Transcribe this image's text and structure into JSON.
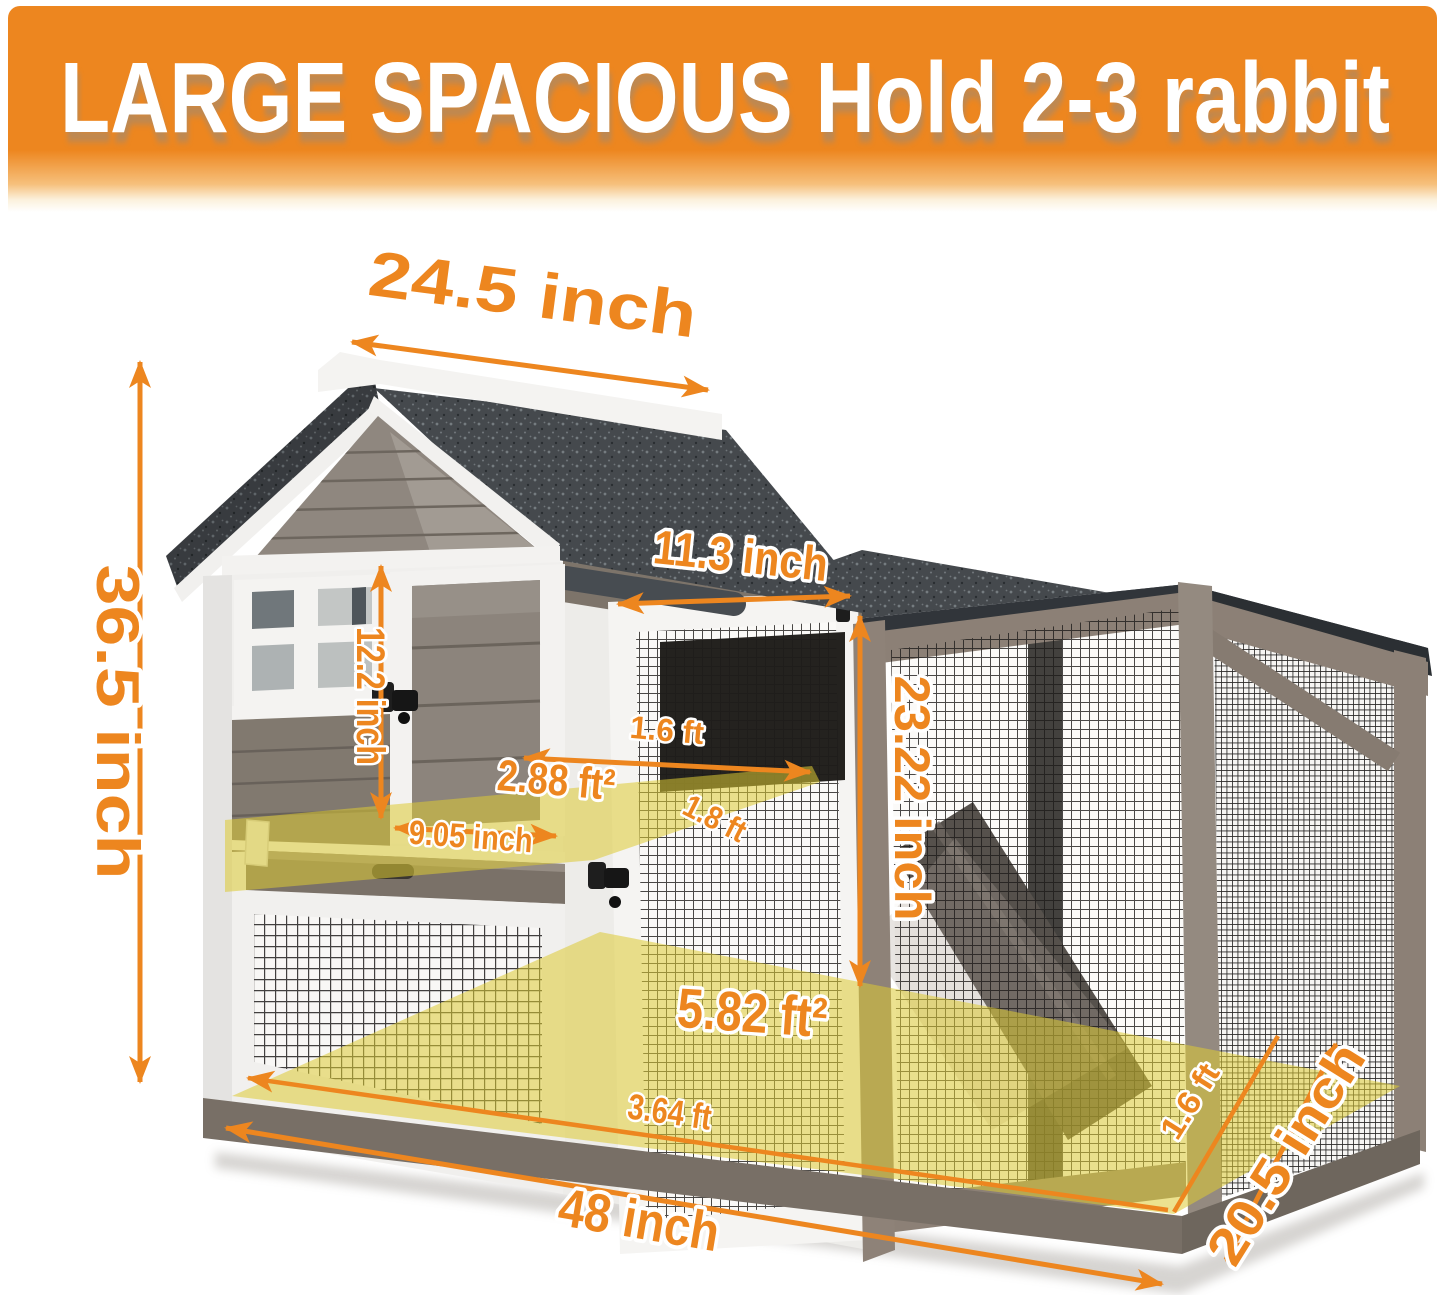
{
  "banner": {
    "title": "LARGE SPACIOUS Hold 2-3 rabbit",
    "bg_color": "#ED861F",
    "text_color": "#FFFFFF"
  },
  "dimensions": {
    "roof_width": "24.5 inch",
    "total_height": "36.5 inch",
    "door_width": "11.3 inch",
    "door_height": "12.2 inch",
    "platform_depth": "1.6 ft",
    "platform_area": "2.88 ft²",
    "platform_width": "9.05 inch",
    "platform_diagonal": "1.8 ft",
    "run_height": "23.22 inch",
    "floor_area": "5.82 ft²",
    "floor_front_width": "3.64 ft",
    "total_width": "48 inch",
    "total_depth": "20.5 inch",
    "floor_side_depth": "1.6 ft"
  },
  "colors": {
    "dimension_accent": "#ED861F",
    "overlay_yellow": "#DCCB33",
    "roof_shingle": "#45494D",
    "wood_trim_white": "#F3F2F0",
    "wood_siding_gray": "#8C847C",
    "frame_taupe": "#8C8076"
  }
}
